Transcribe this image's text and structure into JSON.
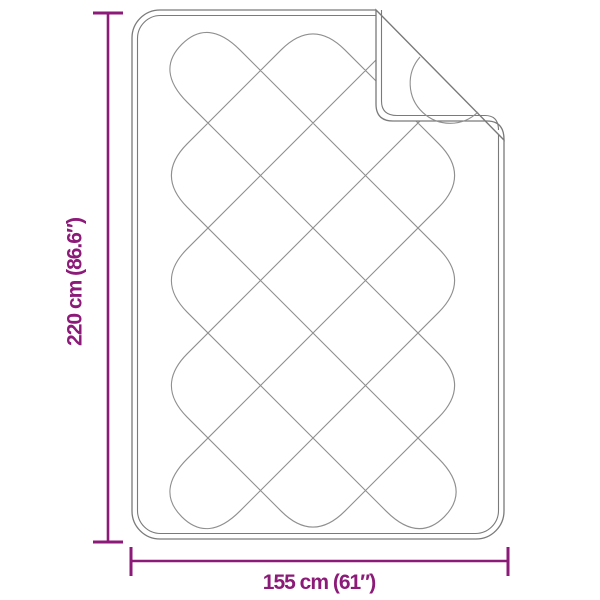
{
  "page": {
    "background": "#FFFFFF"
  },
  "diagram": {
    "height_label": "220 cm (86.6″)",
    "width_label": "155 cm (61″)"
  },
  "colors": {
    "dimension": "#8C1A78",
    "outline": "#7A7A7A",
    "seam": "#7A7A7A",
    "pattern": "#8F8F8F"
  }
}
